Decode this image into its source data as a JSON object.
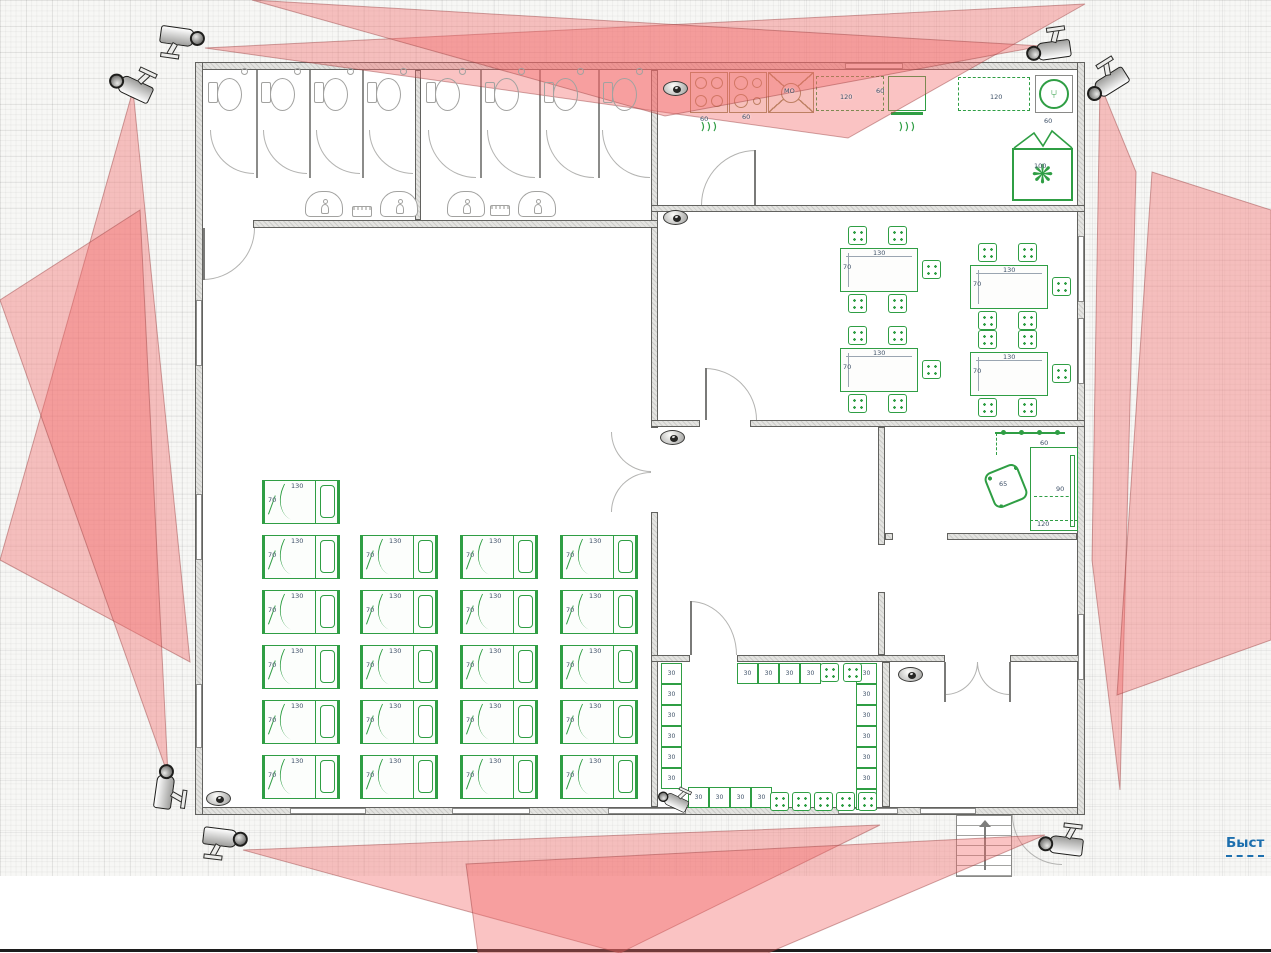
{
  "link": {
    "label": "Быст"
  },
  "colors": {
    "furniture_green": "#2f9e44",
    "cone_fill": "rgba(242,106,106,0.40)",
    "cone_edge": "rgba(150,60,60,0.45)",
    "link_blue": "#1d6fae",
    "appliance_tan": "#9a8f5f"
  },
  "dims": {
    "bed_w": "130",
    "bed_h": "70",
    "table_w": "130",
    "table_h": "70",
    "locker": "30"
  },
  "plan": {
    "beds": [
      [
        262,
        480
      ],
      [
        262,
        535
      ],
      [
        360,
        535
      ],
      [
        460,
        535
      ],
      [
        560,
        535
      ],
      [
        262,
        590
      ],
      [
        360,
        590
      ],
      [
        460,
        590
      ],
      [
        560,
        590
      ],
      [
        262,
        645
      ],
      [
        360,
        645
      ],
      [
        460,
        645
      ],
      [
        560,
        645
      ],
      [
        262,
        700
      ],
      [
        360,
        700
      ],
      [
        460,
        700
      ],
      [
        560,
        700
      ],
      [
        262,
        755
      ],
      [
        360,
        755
      ],
      [
        460,
        755
      ],
      [
        560,
        755
      ]
    ],
    "tables": [
      [
        840,
        248
      ],
      [
        970,
        265
      ],
      [
        840,
        348
      ],
      [
        970,
        352
      ]
    ],
    "table_chair_offsets": [
      [
        8,
        -22
      ],
      [
        48,
        -22
      ],
      [
        82,
        12
      ],
      [
        8,
        46
      ],
      [
        48,
        46
      ]
    ],
    "lockers": [
      [
        661,
        663
      ],
      [
        661,
        684
      ],
      [
        661,
        705
      ],
      [
        661,
        726
      ],
      [
        661,
        747
      ],
      [
        661,
        768
      ],
      [
        856,
        663
      ],
      [
        856,
        684
      ],
      [
        856,
        705
      ],
      [
        856,
        726
      ],
      [
        856,
        747
      ],
      [
        856,
        768
      ],
      [
        856,
        789
      ],
      [
        737,
        663
      ],
      [
        758,
        663
      ],
      [
        779,
        663
      ],
      [
        800,
        663
      ],
      [
        688,
        787
      ],
      [
        709,
        787
      ],
      [
        730,
        787
      ],
      [
        751,
        787
      ]
    ],
    "chairs": [
      [
        820,
        663
      ],
      [
        843,
        663
      ],
      [
        770,
        792
      ],
      [
        792,
        792
      ],
      [
        814,
        792
      ],
      [
        836,
        792
      ],
      [
        858,
        792
      ]
    ],
    "toilets": [
      [
        206,
        66
      ],
      [
        259,
        66
      ],
      [
        312,
        66
      ],
      [
        365,
        66
      ],
      [
        424,
        66
      ],
      [
        483,
        66
      ],
      [
        542,
        66
      ],
      [
        601,
        66
      ]
    ],
    "sinks": [
      [
        305,
        191
      ],
      [
        380,
        191
      ],
      [
        447,
        191
      ],
      [
        518,
        191
      ]
    ],
    "soaps": [
      [
        352,
        206
      ],
      [
        490,
        205
      ]
    ],
    "labels": [
      {
        "t": "60",
        "x": 700,
        "y": 116
      },
      {
        "t": "60",
        "x": 742,
        "y": 114
      },
      {
        "t": "120",
        "x": 840,
        "y": 94
      },
      {
        "t": "60",
        "x": 876,
        "y": 88
      },
      {
        "t": "120",
        "x": 990,
        "y": 94
      },
      {
        "t": "60",
        "x": 1044,
        "y": 118
      },
      {
        "t": "100",
        "x": 1034,
        "y": 163
      },
      {
        "t": "МО",
        "x": 784,
        "y": 88
      },
      {
        "t": "60",
        "x": 1040,
        "y": 440
      },
      {
        "t": "90",
        "x": 1056,
        "y": 486
      },
      {
        "t": "65",
        "x": 999,
        "y": 481
      },
      {
        "t": "120",
        "x": 1037,
        "y": 521
      }
    ]
  },
  "cameras": [
    {
      "kind": "bullet",
      "x": 183,
      "y": 44,
      "rot": 8,
      "name": "cam-top-left-outer"
    },
    {
      "kind": "bullet",
      "x": 132,
      "y": 80,
      "rot": 205,
      "name": "cam-top-left-inner"
    },
    {
      "kind": "bullet",
      "x": 1046,
      "y": 44,
      "rot": 172,
      "name": "cam-top-right-outer"
    },
    {
      "kind": "bullet",
      "x": 1102,
      "y": 80,
      "rot": 148,
      "name": "cam-top-right-inner"
    },
    {
      "kind": "bullet",
      "x": 172,
      "y": 786,
      "rot": 278,
      "name": "cam-bottom-left-up"
    },
    {
      "kind": "bullet",
      "x": 226,
      "y": 845,
      "rot": 7,
      "name": "cam-bottom-left-right"
    },
    {
      "kind": "bullet",
      "x": 1060,
      "y": 838,
      "rot": 187,
      "name": "cam-bottom-right"
    },
    {
      "kind": "bullet",
      "x": 674,
      "y": 796,
      "rot": 205,
      "scale": 0.7,
      "name": "cam-locker-room"
    },
    {
      "kind": "dome",
      "x": 675,
      "y": 88,
      "name": "cam-kitchen"
    },
    {
      "kind": "dome",
      "x": 675,
      "y": 217,
      "name": "cam-dining"
    },
    {
      "kind": "dome",
      "x": 672,
      "y": 437,
      "name": "cam-hall"
    },
    {
      "kind": "dome",
      "x": 218,
      "y": 798,
      "name": "cam-dorm"
    },
    {
      "kind": "dome",
      "x": 910,
      "y": 674,
      "name": "cam-storage"
    }
  ],
  "cones": [
    [
      [
        205,
        48
      ],
      [
        1085,
        4
      ],
      [
        848,
        138
      ]
    ],
    [
      [
        1042,
        46
      ],
      [
        252,
        0
      ],
      [
        665,
        116
      ]
    ],
    [
      [
        133,
        90
      ],
      [
        190,
        662
      ],
      [
        0,
        560
      ]
    ],
    [
      [
        168,
        775
      ],
      [
        140,
        210
      ],
      [
        0,
        300
      ]
    ],
    [
      [
        1100,
        84
      ],
      [
        1136,
        172
      ],
      [
        1120,
        790
      ],
      [
        1092,
        560
      ]
    ],
    [
      [
        1152,
        172
      ],
      [
        1271,
        210
      ],
      [
        1271,
        640
      ],
      [
        1117,
        695
      ]
    ],
    [
      [
        243,
        850
      ],
      [
        880,
        825
      ],
      [
        620,
        953
      ]
    ],
    [
      [
        1045,
        835
      ],
      [
        466,
        864
      ],
      [
        478,
        953
      ],
      [
        768,
        953
      ]
    ]
  ]
}
